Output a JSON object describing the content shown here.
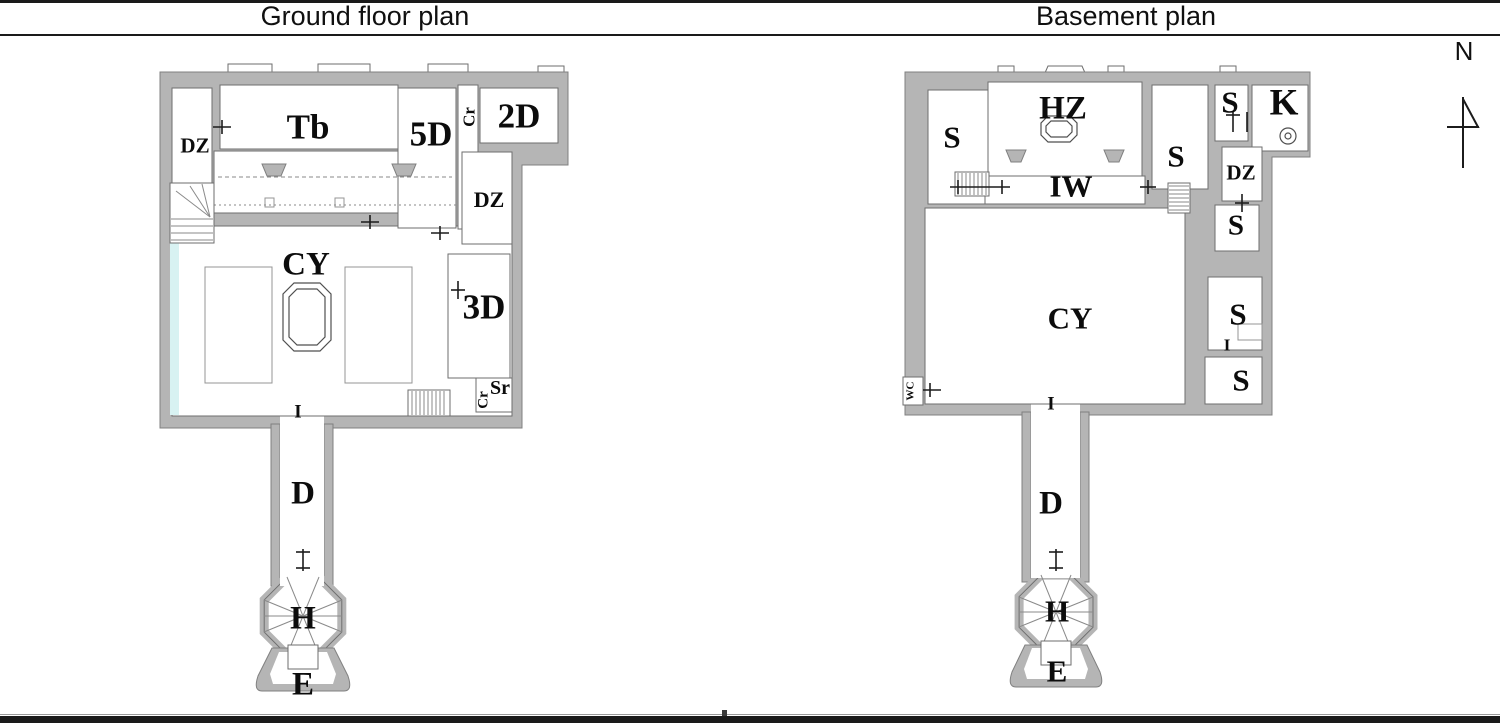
{
  "header": {
    "left_title": "Ground floor plan",
    "right_title": "Basement plan"
  },
  "compass": {
    "label": "N"
  },
  "colors": {
    "wall": "#b5b5b5",
    "wall_edge": "#808080",
    "room_line": "#6e6e6e",
    "detail": "#8a8a8a",
    "tick": "#1c1c1c",
    "water": "#d8f2f2",
    "label": "#0c0c0c",
    "border": "#1a1a1a"
  },
  "plans": [
    {
      "id": "ground-floor",
      "labels": [
        {
          "text": "DZ",
          "x": 195,
          "y": 146,
          "size": 21
        },
        {
          "text": "Tb",
          "x": 308,
          "y": 127,
          "size": 35
        },
        {
          "text": "5D",
          "x": 431,
          "y": 134,
          "size": 35
        },
        {
          "text": "Cr",
          "x": 469,
          "y": 117,
          "size": 17,
          "rot": -90
        },
        {
          "text": "2D",
          "x": 519,
          "y": 116,
          "size": 35
        },
        {
          "text": "DZ",
          "x": 489,
          "y": 200,
          "size": 22
        },
        {
          "text": "CY",
          "x": 306,
          "y": 265,
          "size": 33
        },
        {
          "text": "3D",
          "x": 484,
          "y": 307,
          "size": 35
        },
        {
          "text": "Sr",
          "x": 500,
          "y": 388,
          "size": 20
        },
        {
          "text": "Cr",
          "x": 484,
          "y": 400,
          "size": 15,
          "rot": -90
        },
        {
          "text": "I",
          "x": 298,
          "y": 412,
          "size": 19
        },
        {
          "text": "D",
          "x": 303,
          "y": 494,
          "size": 33
        },
        {
          "text": "H",
          "x": 303,
          "y": 619,
          "size": 33
        },
        {
          "text": "E",
          "x": 303,
          "y": 685,
          "size": 33
        }
      ]
    },
    {
      "id": "basement",
      "labels": [
        {
          "text": "S",
          "x": 952,
          "y": 137,
          "size": 31
        },
        {
          "text": "HZ",
          "x": 1063,
          "y": 109,
          "size": 33
        },
        {
          "text": "IW",
          "x": 1071,
          "y": 186,
          "size": 31
        },
        {
          "text": "S",
          "x": 1176,
          "y": 156,
          "size": 31
        },
        {
          "text": "S",
          "x": 1230,
          "y": 102,
          "size": 31
        },
        {
          "text": "K",
          "x": 1284,
          "y": 103,
          "size": 37
        },
        {
          "text": "DZ",
          "x": 1241,
          "y": 173,
          "size": 21
        },
        {
          "text": "S",
          "x": 1236,
          "y": 226,
          "size": 29
        },
        {
          "text": "S",
          "x": 1238,
          "y": 314,
          "size": 31
        },
        {
          "text": "I",
          "x": 1227,
          "y": 345,
          "size": 17
        },
        {
          "text": "S",
          "x": 1241,
          "y": 380,
          "size": 31
        },
        {
          "text": "CY",
          "x": 1070,
          "y": 318,
          "size": 31
        },
        {
          "text": "WC",
          "x": 911,
          "y": 391,
          "size": 11,
          "rot": -90
        },
        {
          "text": "I",
          "x": 1051,
          "y": 404,
          "size": 19
        },
        {
          "text": "D",
          "x": 1051,
          "y": 504,
          "size": 33
        },
        {
          "text": "H",
          "x": 1057,
          "y": 611,
          "size": 31
        },
        {
          "text": "E",
          "x": 1057,
          "y": 671,
          "size": 31
        }
      ]
    }
  ]
}
